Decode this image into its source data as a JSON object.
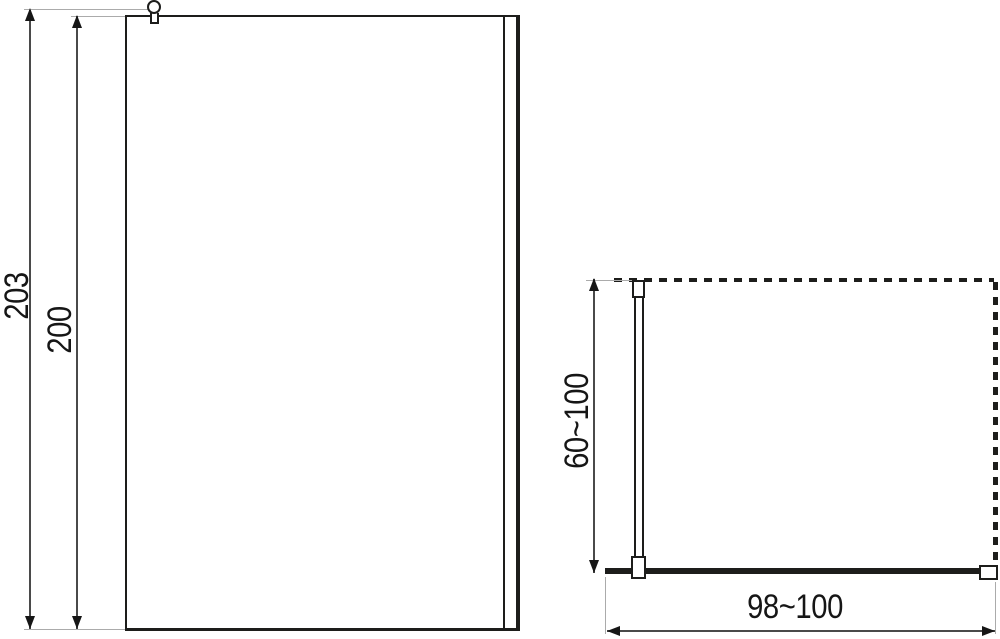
{
  "drawing": {
    "front_view": {
      "total_height": "203",
      "glass_height": "200"
    },
    "top_view": {
      "support_bar_length": "60~100",
      "panel_width": "98~100"
    },
    "colors": {
      "line": "#1d1d1b",
      "dimension_line": "#4a4a4a",
      "extension_line": "#ababab",
      "background": "#ffffff"
    }
  }
}
